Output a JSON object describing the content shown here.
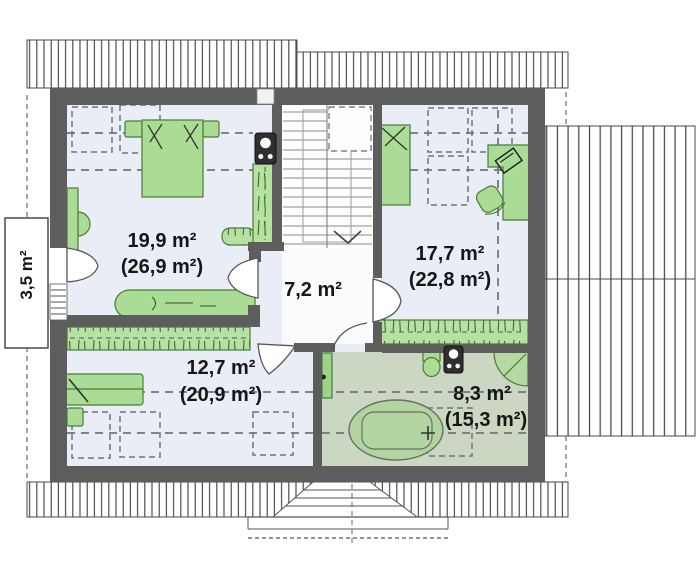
{
  "plan": {
    "type": "floor-plan-upper-storey",
    "rooms": {
      "bedroom_top_left": {
        "area": "19,9 m²",
        "area_with_slopes": "(26,9 m²)"
      },
      "bedroom_top_right": {
        "area": "17,7 m²",
        "area_with_slopes": "(22,8 m²)"
      },
      "hall": {
        "area": "7,2 m²"
      },
      "bedroom_bottom_left": {
        "area": "12,7 m²",
        "area_with_slopes": "(20,9 m²)"
      },
      "bathroom": {
        "area": "8,3 m²",
        "area_with_slopes": "(15,3 m²)"
      },
      "balcony": {
        "area": "3,5 m²"
      }
    },
    "colors": {
      "wall": "#5d5d5d",
      "floor": "#e9edf5",
      "hall_floor": "#fafbfd",
      "bathroom_floor": "#cbd7c2",
      "furniture_green": "#abdc96",
      "furniture_stroke": "#4c7a38",
      "text": "#161616"
    }
  }
}
